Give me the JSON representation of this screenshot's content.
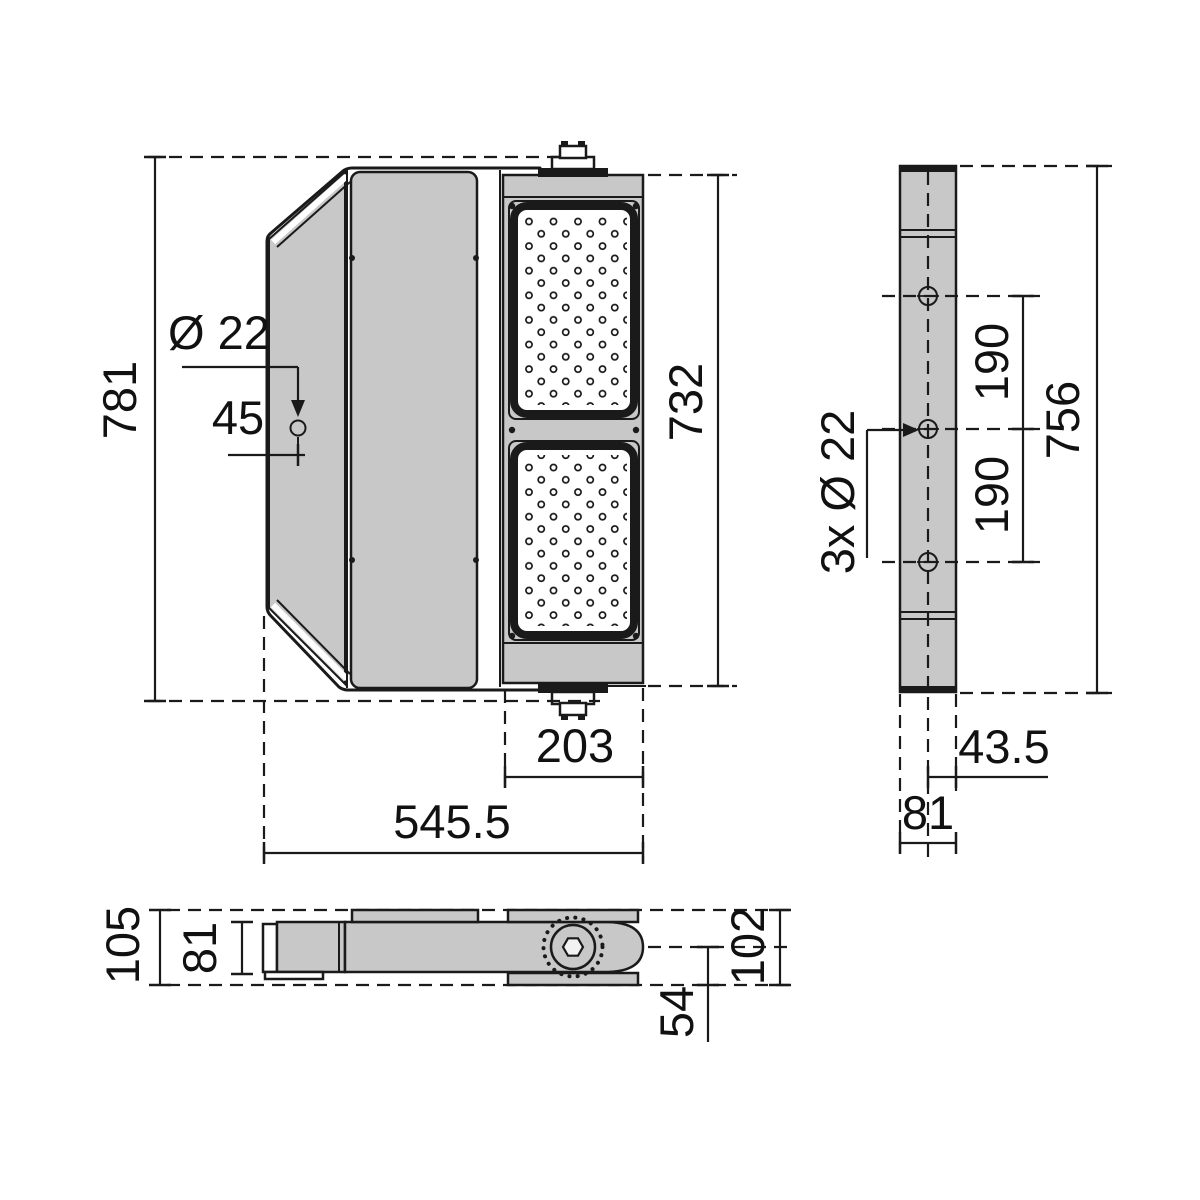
{
  "drawing": {
    "title": "floodlight-dimension-drawing",
    "colors": {
      "body_gray": "#c8c8c8",
      "line": "#1a1a1a",
      "background": "#ffffff"
    },
    "front_view": {
      "overall_height": "781",
      "mount_hole_diameter": "Ø 22",
      "mount_hole_offset": "45",
      "led_frame_height": "732",
      "led_frame_width": "203",
      "overall_width": "545.5"
    },
    "side_view": {
      "hole_spacing_upper": "190",
      "hole_spacing_lower": "190",
      "bracket_height": "756",
      "holes_callout": "3x Ø 22",
      "hole_to_front": "43.5",
      "depth": "81"
    },
    "top_view": {
      "overall_depth": "105",
      "body_depth": "81",
      "bracket_depth": "102",
      "pivot_to_face": "54"
    }
  }
}
